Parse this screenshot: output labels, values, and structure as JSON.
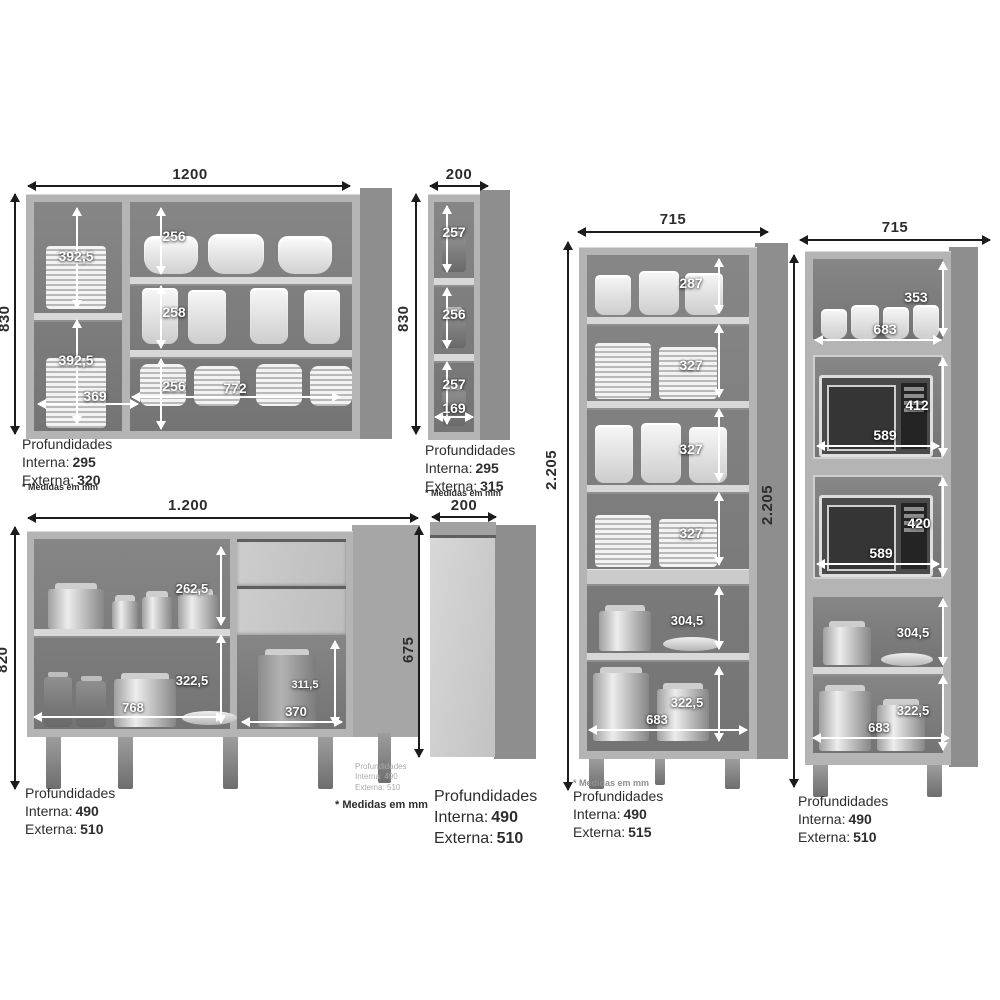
{
  "wall_wide": {
    "width": "1200",
    "height": "830",
    "left_top_h": "392,5",
    "left_bottom_h": "392,5",
    "left_w": "369",
    "rows": [
      "256",
      "258",
      "256"
    ],
    "rows_w": "772",
    "depth_title": "Profundidades",
    "depth_in_label": "Interna:",
    "depth_in": "295",
    "depth_ex_label": "Externa:",
    "depth_ex": "320",
    "note": "* Medidas em mm"
  },
  "wall_narrow": {
    "width": "200",
    "height": "830",
    "rows": [
      "257",
      "256",
      "257"
    ],
    "bottom_w": "169",
    "depth_title": "Profundidades",
    "depth_in_label": "Interna:",
    "depth_in": "295",
    "depth_ex_label": "Externa:",
    "depth_ex": "315",
    "note": "* Medidas em mm"
  },
  "base_wide": {
    "width": "1.200",
    "height": "820",
    "top_h": "262,5",
    "bottom_h": "322,5",
    "bottom_w": "768",
    "right_h": "311,5",
    "right_w": "370",
    "depth_title": "Profundidades",
    "depth_in_label": "Interna:",
    "depth_in": "490",
    "depth_ex_label": "Externa:",
    "depth_ex": "510",
    "faint_title": "Profundidades",
    "faint_in": "Interna: 490",
    "faint_ex": "Externa: 510",
    "note": "* Medidas em mm"
  },
  "base_narrow": {
    "width": "200",
    "height": "675",
    "depth_title": "Profundidades",
    "depth_in_label": "Interna:",
    "depth_in": "490",
    "depth_ex_label": "Externa:",
    "depth_ex": "510"
  },
  "tall_shelves": {
    "width": "715",
    "height": "2.205",
    "rows": [
      "287",
      "327",
      "327",
      "327",
      "304,5",
      "322,5"
    ],
    "bottom_w": "683",
    "note": "* Medidas em mm",
    "depth_title": "Profundidades",
    "depth_in_label": "Interna:",
    "depth_in": "490",
    "depth_ex_label": "Externa:",
    "depth_ex": "515"
  },
  "tall_oven": {
    "width": "715",
    "height": "2.205",
    "row1_h": "353",
    "row1_w": "683",
    "row2_h": "412",
    "row2_w": "589",
    "row3_h": "420",
    "row3_w": "589",
    "row4_h": "304,5",
    "row5_h": "322,5",
    "row5_w": "683",
    "depth_title": "Profundidades",
    "depth_in_label": "Interna:",
    "depth_in": "490",
    "depth_ex_label": "Externa:",
    "depth_ex": "510"
  }
}
